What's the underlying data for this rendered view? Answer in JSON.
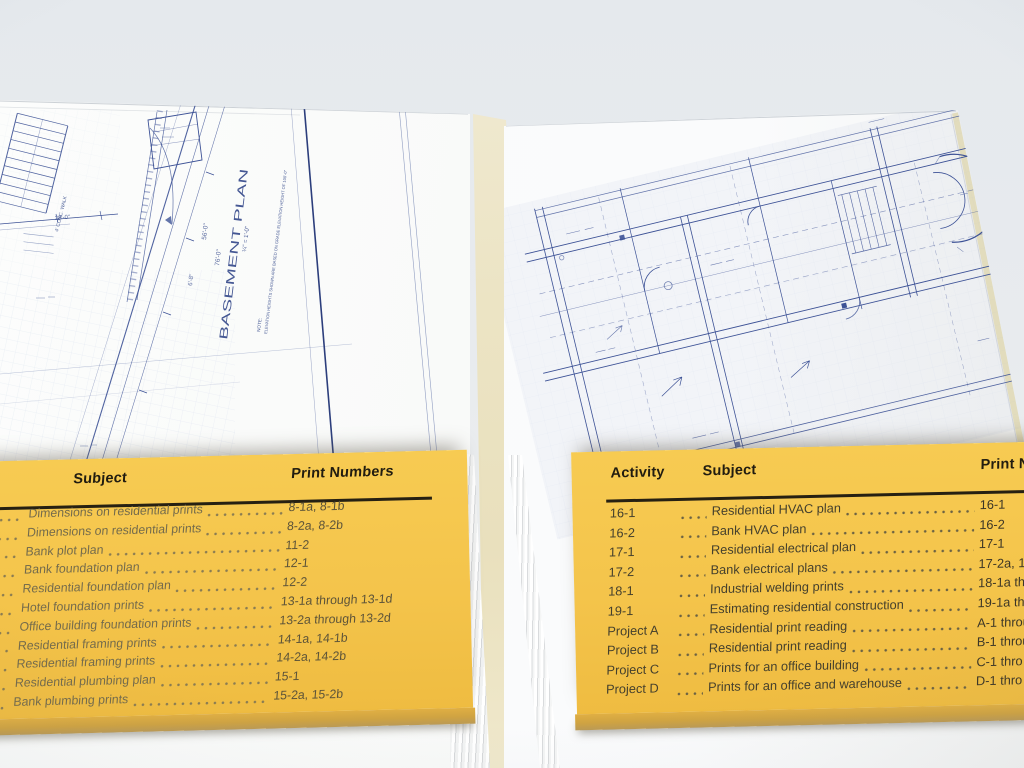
{
  "palette": {
    "card_yellow": "#f4c44b",
    "card_edge": "#cfa342",
    "blueprint_blue": "#3d5296",
    "spine_cream": "#ece4c4",
    "background_gray": "#e8ebee"
  },
  "left_blueprint": {
    "title": "BASEMENT PLAN",
    "scale": "¼\" = 1'-0\"",
    "note_label": "NOTE:",
    "note_text": "ELEVATION HEIGHTS SHOWN ARE BASED ON GRADE ELEVATION HEIGHT OF 100'-0\"",
    "dims": [
      "56'-0\"",
      "76'-0\"",
      "6'-8\"",
      "28'-0\"",
      "4' CONC. WALK"
    ]
  },
  "left_card": {
    "headers": {
      "subject": "Subject",
      "print_numbers": "Print Numbers"
    },
    "rows": [
      {
        "subject": "Dimensions on residential prints",
        "numbers": "8-1a, 8-1b"
      },
      {
        "subject": "Dimensions on residential prints",
        "numbers": "8-2a, 8-2b"
      },
      {
        "subject": "Bank plot plan",
        "numbers": "11-2"
      },
      {
        "subject": "Bank foundation plan",
        "numbers": "12-1"
      },
      {
        "subject": "Residential foundation plan",
        "numbers": "12-2"
      },
      {
        "subject": "Hotel foundation prints",
        "numbers": "13-1a through 13-1d"
      },
      {
        "subject": "Office building foundation prints",
        "numbers": "13-2a through 13-2d"
      },
      {
        "subject": "Residential framing prints",
        "numbers": "14-1a, 14-1b"
      },
      {
        "subject": "Residential framing prints",
        "numbers": "14-2a, 14-2b"
      },
      {
        "subject": "Residential plumbing plan",
        "numbers": "15-1"
      },
      {
        "subject": "Bank plumbing prints",
        "numbers": "15-2a, 15-2b"
      }
    ]
  },
  "right_card": {
    "headers": {
      "activity": "Activity",
      "subject": "Subject",
      "print_numbers": "Print Numb"
    },
    "rows": [
      {
        "activity": "16-1",
        "subject": "Residential HVAC plan",
        "numbers": "16-1"
      },
      {
        "activity": "16-2",
        "subject": "Bank HVAC plan",
        "numbers": "16-2"
      },
      {
        "activity": "17-1",
        "subject": "Residential electrical plan",
        "numbers": "17-1"
      },
      {
        "activity": "17-2",
        "subject": "Bank electrical plans",
        "numbers": "17-2a, 17-2"
      },
      {
        "activity": "18-1",
        "subject": "Industrial welding prints",
        "numbers": "18-1a throu"
      },
      {
        "activity": "19-1",
        "subject": "Estimating residential construction",
        "numbers": "19-1a thro"
      },
      {
        "activity": "Project A",
        "subject": "Residential print reading",
        "numbers": "A-1 throu"
      },
      {
        "activity": "Project B",
        "subject": "Residential print reading",
        "numbers": "B-1 throu"
      },
      {
        "activity": "Project C",
        "subject": "Prints for an office building",
        "numbers": "C-1 thro"
      },
      {
        "activity": "Project D",
        "subject": "Prints for an office and warehouse",
        "numbers": "D-1 thro"
      }
    ]
  }
}
